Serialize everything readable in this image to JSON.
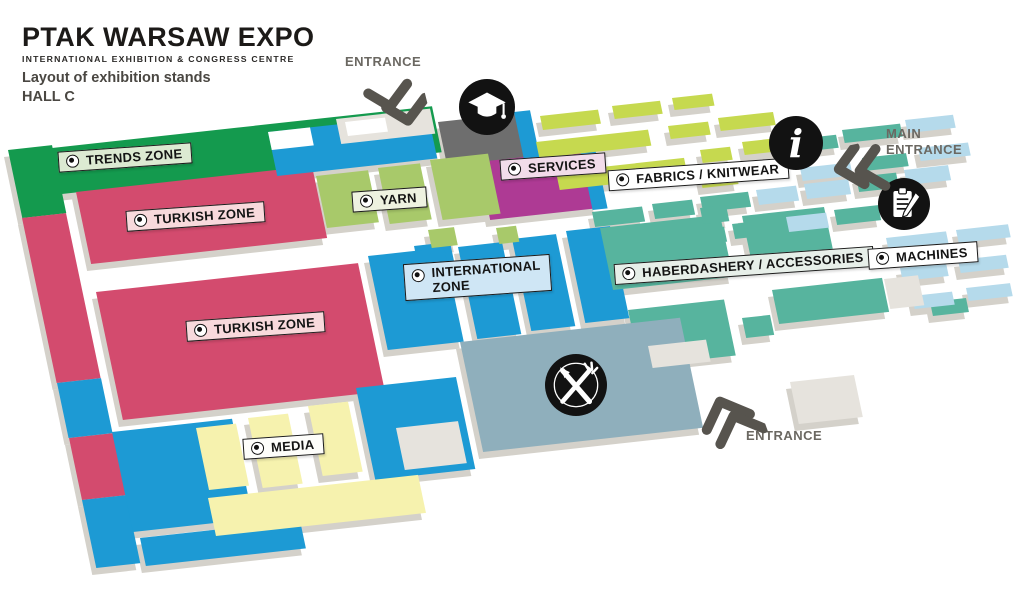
{
  "header": {
    "title": "PTAK WARSAW EXPO",
    "subtitle": "INTERNATIONAL EXHIBITION & CONGRESS CENTRE",
    "caption_line1": "Layout of exhibition stands",
    "caption_line2": "HALL C"
  },
  "zones": {
    "trends": {
      "label": "TRENDS ZONE",
      "color": "#149a4e",
      "label_bg": "#dcead2"
    },
    "turkish": {
      "label": "TURKISH ZONE",
      "color": "#d34b6e",
      "label_bg": "#f8d9dc"
    },
    "yarn": {
      "label": "YARN",
      "color": "#a8c96a",
      "label_bg": "#eef2e0"
    },
    "services": {
      "label": "SERVICES",
      "color": "#ae3a94",
      "label_bg": "#f2dcea"
    },
    "fabrics": {
      "label": "FABRICS / KNITWEAR",
      "color": "#c6d94f",
      "label_bg": "#ffffff"
    },
    "international": {
      "label_line1": "INTERNATIONAL",
      "label_line2": "ZONE",
      "color": "#1d9ad4",
      "label_bg": "#cfe6f5"
    },
    "haberdashery": {
      "label": "HABERDASHERY / ACCESSORIES",
      "color": "#57b49e",
      "label_bg": "#e7efe9"
    },
    "machines": {
      "label": "MACHINES",
      "color": "#b5daeb",
      "label_bg": "#ffffff"
    },
    "media": {
      "label": "MEDIA",
      "color": "#f6f2ae",
      "label_bg": "#fdfdfa"
    }
  },
  "entrances": {
    "top": {
      "label": "ENTRANCE"
    },
    "main": {
      "label_line1": "MAIN",
      "label_line2": "ENTRANCE"
    },
    "bottom": {
      "label": "ENTRANCE"
    }
  },
  "icons": {
    "education": "graduation-cap",
    "info": "information-point",
    "registration": "registration-desk",
    "restaurant": "restaurant"
  },
  "palette": {
    "background": "#ffffff",
    "block_base": "#d4d1ca",
    "dark_gray_block": "#6e6e6e",
    "light_gray_block": "#e6e3dd",
    "restaurant_block": "#8fafbc",
    "arrow": "#57544e",
    "entrance_text": "#6b6862",
    "icon_bg": "#121212"
  }
}
